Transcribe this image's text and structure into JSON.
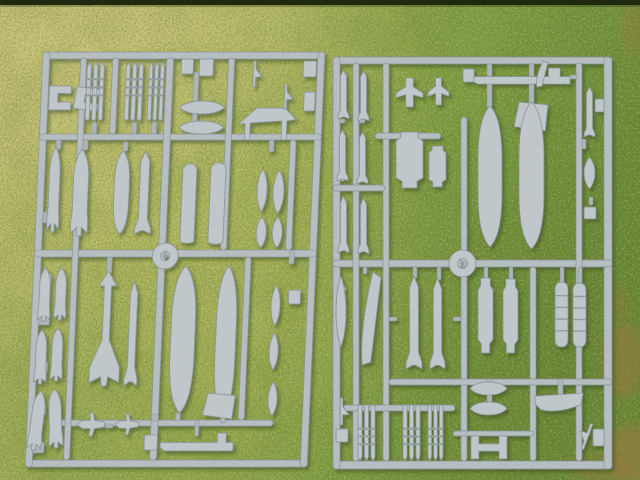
{
  "scene": {
    "width": 640,
    "height": 480,
    "colors": {
      "sprue_plastic": "#b6bec2",
      "sprue_part": "#c0c7cb",
      "sprue_stub": "#adb5b9",
      "sprue_band": "#929da1",
      "sprue_shadowline": "#879296",
      "sprue_highlight": "#d4d9db",
      "grass_straw": "#c9c178",
      "grass_mid": "#b2b763",
      "grass_mid2": "#9cac50",
      "grass_green": "#82a045",
      "grass_dark": "#6d8c38",
      "dead_grass": "#97783f",
      "top_strip": "#1e290d",
      "shadow": "#36481a"
    },
    "top_strip": {
      "height": 5
    },
    "dead_grass_patches": [
      {
        "cx": 624,
        "cy": 360,
        "rx": 20,
        "ry": 38,
        "o": 0.55
      },
      {
        "cx": 630,
        "cy": 455,
        "rx": 24,
        "ry": 30,
        "o": 0.6
      },
      {
        "cx": 616,
        "cy": 302,
        "rx": 9,
        "ry": 16,
        "o": 0.45
      },
      {
        "cx": 600,
        "cy": 468,
        "rx": 30,
        "ry": 12,
        "o": 0.5
      },
      {
        "cx": 634,
        "cy": 30,
        "rx": 12,
        "ry": 28,
        "o": 0.35
      }
    ],
    "sprues": [
      {
        "name": "left-sprue",
        "x": 43,
        "y": 52,
        "skew": -2.46,
        "rails": [
          [
            0,
            0,
            282,
            7
          ],
          [
            0,
            408,
            282,
            7
          ],
          [
            0,
            0,
            7,
            415
          ],
          [
            275,
            0,
            7,
            415
          ],
          [
            0,
            82,
            282,
            6
          ],
          [
            0,
            198,
            282,
            7
          ],
          [
            34,
            368,
            212,
            6
          ],
          [
            38,
            6,
            6,
            402
          ],
          [
            124,
            6,
            7,
            402
          ],
          [
            70,
            6,
            6,
            76
          ],
          [
            186,
            6,
            6,
            192
          ],
          [
            211,
            205,
            6,
            163
          ],
          [
            251,
            88,
            6,
            110
          ]
        ],
        "stubs": [
          [
            7,
            160,
            11,
            11
          ],
          [
            7,
            222,
            11,
            11
          ],
          [
            7,
            262,
            11,
            11
          ],
          [
            7,
            310,
            11,
            11
          ],
          [
            7,
            352,
            11,
            11
          ],
          [
            7,
            390,
            11,
            11
          ],
          [
            52,
            70,
            5,
            12
          ],
          [
            92,
            70,
            5,
            12
          ],
          [
            112,
            70,
            5,
            12
          ],
          [
            152,
            20,
            5,
            62
          ],
          [
            73,
            205,
            5,
            16
          ],
          [
            148,
            361,
            5,
            8
          ],
          [
            193,
            365,
            5,
            6
          ],
          [
            168,
            368,
            4,
            16
          ],
          [
            78,
            372,
            8,
            4
          ],
          [
            44,
            88,
            5,
            10
          ],
          [
            17,
            88,
            5,
            9
          ],
          [
            84,
            90,
            5,
            9
          ],
          [
            230,
            88,
            5,
            12
          ],
          [
            255,
            198,
            5,
            14
          ],
          [
            124,
            362,
            7,
            7
          ]
        ],
        "parts": [
          {
            "t": "clip",
            "x": 8,
            "y": 34,
            "w": 22,
            "h": 24
          },
          {
            "t": "clip",
            "x": 34,
            "y": 36,
            "w": 24,
            "h": 22,
            "r": 8
          },
          {
            "t": "rocketpod",
            "x": 45,
            "y": 10,
            "w": 17,
            "h": 58
          },
          {
            "t": "rocketpod",
            "x": 84,
            "y": 10,
            "w": 17,
            "h": 58
          },
          {
            "t": "rocketpod",
            "x": 107,
            "y": 10,
            "w": 15,
            "h": 58
          },
          {
            "t": "block",
            "x": 139,
            "y": 7,
            "w": 12,
            "h": 15
          },
          {
            "t": "block",
            "x": 157,
            "y": 7,
            "w": 14,
            "h": 17
          },
          {
            "t": "lens",
            "x": 139,
            "y": 49,
            "w": 45,
            "h": 13
          },
          {
            "t": "lens",
            "x": 139,
            "y": 69,
            "w": 45,
            "h": 13
          },
          {
            "t": "canopy",
            "x": 199,
            "y": 54,
            "w": 57,
            "h": 34
          },
          {
            "t": "arrow",
            "x": 205,
            "y": 9,
            "w": 15,
            "h": 26
          },
          {
            "t": "arrow",
            "x": 237,
            "y": 32,
            "w": 15,
            "h": 25
          },
          {
            "t": "block",
            "x": 261,
            "y": 9,
            "w": 13,
            "h": 16
          },
          {
            "t": "block",
            "x": 263,
            "y": 40,
            "w": 11,
            "h": 19
          },
          {
            "t": "bomb",
            "x": 11,
            "y": 95,
            "w": 12,
            "h": 85
          },
          {
            "t": "bomb",
            "x": 35,
            "y": 97,
            "w": 17,
            "h": 87
          },
          {
            "t": "tank",
            "x": 77,
            "y": 99,
            "w": 15,
            "h": 83
          },
          {
            "t": "missile",
            "x": 99,
            "y": 99,
            "w": 16,
            "h": 83
          },
          {
            "t": "cylpod",
            "x": 145,
            "y": 112,
            "w": 14,
            "h": 81
          },
          {
            "t": "cylpod",
            "x": 173,
            "y": 111,
            "w": 15,
            "h": 83
          },
          {
            "t": "spindle",
            "x": 220,
            "y": 117,
            "w": 10,
            "h": 43
          },
          {
            "t": "spindle",
            "x": 236,
            "y": 118,
            "w": 11,
            "h": 44
          },
          {
            "t": "spindle",
            "x": 221,
            "y": 165,
            "w": 10,
            "h": 31
          },
          {
            "t": "spindle",
            "x": 237,
            "y": 165,
            "w": 10,
            "h": 31
          },
          {
            "t": "ring",
            "x": 118,
            "y": 191,
            "w": 26,
            "h": 26
          },
          {
            "t": "bomb",
            "x": 6,
            "y": 216,
            "w": 12,
            "h": 53
          },
          {
            "t": "bomb",
            "x": 22,
            "y": 216,
            "w": 12,
            "h": 52
          },
          {
            "t": "bomb",
            "x": 5,
            "y": 278,
            "w": 12,
            "h": 54
          },
          {
            "t": "bomb",
            "x": 21,
            "y": 276,
            "w": 12,
            "h": 53
          },
          {
            "t": "bomb",
            "x": 3,
            "y": 339,
            "w": 14,
            "h": 59,
            "r": 5
          },
          {
            "t": "bomb",
            "x": 21,
            "y": 337,
            "w": 14,
            "h": 59,
            "r": -4
          },
          {
            "t": "walleye",
            "x": 60,
            "y": 219,
            "w": 30,
            "h": 115
          },
          {
            "t": "missile",
            "x": 95,
            "y": 229,
            "w": 13,
            "h": 105
          },
          {
            "t": "tank",
            "x": 140,
            "y": 214,
            "w": 24,
            "h": 147
          },
          {
            "t": "tank",
            "x": 185,
            "y": 214,
            "w": 20,
            "h": 151
          },
          {
            "t": "plate",
            "x": 175,
            "y": 341,
            "w": 32,
            "h": 26
          },
          {
            "t": "spindle",
            "x": 239,
            "y": 233,
            "w": 9,
            "h": 41
          },
          {
            "t": "spindle",
            "x": 239,
            "y": 281,
            "w": 9,
            "h": 37
          },
          {
            "t": "block",
            "x": 256,
            "y": 238,
            "w": 12,
            "h": 14
          },
          {
            "t": "spindle",
            "x": 240,
            "y": 330,
            "w": 9,
            "h": 34
          },
          {
            "t": "plane",
            "x": 50,
            "y": 361,
            "w": 28,
            "h": 23
          },
          {
            "t": "plane",
            "x": 88,
            "y": 362,
            "w": 24,
            "h": 21
          },
          {
            "t": "rodpart",
            "x": 134,
            "y": 381,
            "w": 73,
            "h": 21
          },
          {
            "t": "block",
            "x": 118,
            "y": 383,
            "w": 13,
            "h": 15
          }
        ]
      },
      {
        "name": "right-sprue",
        "x": 333,
        "y": 57,
        "skew": 0,
        "rails": [
          [
            0,
            0,
            279,
            7
          ],
          [
            0,
            404,
            279,
            8
          ],
          [
            0,
            0,
            7,
            412
          ],
          [
            271,
            0,
            8,
            412
          ],
          [
            0,
            203,
            279,
            7
          ],
          [
            20,
            6,
            6,
            398
          ],
          [
            50,
            6,
            6,
            398
          ],
          [
            243,
            6,
            6,
            398
          ],
          [
            128,
            60,
            6,
            150
          ],
          [
            128,
            210,
            6,
            194
          ],
          [
            197,
            210,
            6,
            194
          ],
          [
            0,
            128,
            52,
            6
          ],
          [
            42,
            76,
            66,
            6
          ],
          [
            56,
            322,
            223,
            6
          ],
          [
            10,
            348,
            112,
            6
          ],
          [
            120,
            374,
            81,
            5
          ]
        ],
        "stubs": [
          [
            154,
            7,
            5,
            44
          ],
          [
            196,
            7,
            5,
            40
          ],
          [
            26,
            62,
            6,
            4
          ],
          [
            26,
            120,
            6,
            4
          ],
          [
            7,
            62,
            5,
            4
          ],
          [
            7,
            120,
            5,
            4
          ],
          [
            151,
            210,
            4,
            13
          ],
          [
            176,
            210,
            4,
            14
          ],
          [
            80,
            210,
            4,
            11
          ],
          [
            104,
            210,
            4,
            13
          ],
          [
            227,
            210,
            4,
            17
          ],
          [
            245,
            210,
            4,
            18
          ],
          [
            154,
            322,
            5,
            26
          ],
          [
            225,
            322,
            5,
            16
          ],
          [
            30,
            210,
            4,
            7
          ],
          [
            8,
            230,
            5,
            4
          ],
          [
            134,
            18,
            8,
            4
          ],
          [
            236,
            18,
            8,
            4
          ],
          [
            249,
            82,
            4,
            10
          ],
          [
            256,
            140,
            4,
            8
          ],
          [
            120,
            260,
            8,
            4
          ],
          [
            56,
            260,
            8,
            4
          ]
        ],
        "parts": [
          {
            "t": "missile",
            "x": 5,
            "y": 13,
            "w": 11,
            "h": 49
          },
          {
            "t": "missile",
            "x": 25,
            "y": 14,
            "w": 11,
            "h": 50
          },
          {
            "t": "missile",
            "x": 4,
            "y": 73,
            "w": 11,
            "h": 51
          },
          {
            "t": "missile",
            "x": 24,
            "y": 75,
            "w": 11,
            "h": 52
          },
          {
            "t": "missile",
            "x": 5,
            "y": 139,
            "w": 11,
            "h": 57
          },
          {
            "t": "missile",
            "x": 25,
            "y": 141,
            "w": 11,
            "h": 56
          },
          {
            "t": "pylon",
            "x": 63,
            "y": 21,
            "w": 27,
            "h": 29
          },
          {
            "t": "pylon",
            "x": 95,
            "y": 21,
            "w": 21,
            "h": 27
          },
          {
            "t": "lgb",
            "x": 63,
            "y": 75,
            "w": 27,
            "h": 56
          },
          {
            "t": "lgb",
            "x": 96,
            "y": 89,
            "w": 17,
            "h": 41
          },
          {
            "t": "rodpart",
            "x": 139,
            "y": 11,
            "w": 98,
            "h": 19
          },
          {
            "t": "blade",
            "x": 199,
            "y": 4,
            "w": 16,
            "h": 26
          },
          {
            "t": "block",
            "x": 130,
            "y": 12,
            "w": 11,
            "h": 13
          },
          {
            "t": "tank",
            "x": 145,
            "y": 49,
            "w": 24,
            "h": 141
          },
          {
            "t": "plate",
            "x": 181,
            "y": 45,
            "w": 34,
            "h": 29
          },
          {
            "t": "tank",
            "x": 186,
            "y": 45,
            "w": 25,
            "h": 147
          },
          {
            "t": "missile",
            "x": 251,
            "y": 30,
            "w": 11,
            "h": 50
          },
          {
            "t": "spindle",
            "x": 251,
            "y": 100,
            "w": 11,
            "h": 32
          },
          {
            "t": "block",
            "x": 262,
            "y": 42,
            "w": 9,
            "h": 13
          },
          {
            "t": "block",
            "x": 251,
            "y": 150,
            "w": 12,
            "h": 12
          },
          {
            "t": "ring",
            "x": 116,
            "y": 193,
            "w": 27,
            "h": 27
          },
          {
            "t": "blade",
            "x": 21,
            "y": 215,
            "w": 27,
            "h": 93
          },
          {
            "t": "spindle",
            "x": 3,
            "y": 219,
            "w": 10,
            "h": 71
          },
          {
            "t": "missile",
            "x": 73,
            "y": 219,
            "w": 16,
            "h": 93
          },
          {
            "t": "missile",
            "x": 97,
            "y": 221,
            "w": 15,
            "h": 91
          },
          {
            "t": "lgb",
            "x": 145,
            "y": 221,
            "w": 15,
            "h": 75
          },
          {
            "t": "lgb",
            "x": 170,
            "y": 222,
            "w": 15,
            "h": 74
          },
          {
            "t": "ribbed",
            "x": 222,
            "y": 225,
            "w": 13,
            "h": 65
          },
          {
            "t": "ribbed",
            "x": 240,
            "y": 226,
            "w": 13,
            "h": 64
          },
          {
            "t": "lens",
            "x": 137,
            "y": 325,
            "w": 37,
            "h": 13
          },
          {
            "t": "lens",
            "x": 137,
            "y": 345,
            "w": 37,
            "h": 13
          },
          {
            "t": "boat",
            "x": 202,
            "y": 336,
            "w": 48,
            "h": 21
          },
          {
            "t": "rocketpod",
            "x": 25,
            "y": 348,
            "w": 17,
            "h": 56,
            "r": 180
          },
          {
            "t": "rocketpod",
            "x": 70,
            "y": 348,
            "w": 17,
            "h": 56,
            "r": 180
          },
          {
            "t": "rocketpod",
            "x": 95,
            "y": 348,
            "w": 15,
            "h": 56,
            "r": 180
          },
          {
            "t": "arrow",
            "x": 1,
            "y": 341,
            "w": 15,
            "h": 27
          },
          {
            "t": "block",
            "x": 3,
            "y": 372,
            "w": 12,
            "h": 13
          },
          {
            "t": "hpart",
            "x": 138,
            "y": 379,
            "w": 36,
            "h": 23
          },
          {
            "t": "arrow",
            "x": 246,
            "y": 366,
            "w": 16,
            "h": 27,
            "r": 200
          },
          {
            "t": "block",
            "x": 260,
            "y": 372,
            "w": 11,
            "h": 17
          }
        ]
      }
    ]
  }
}
